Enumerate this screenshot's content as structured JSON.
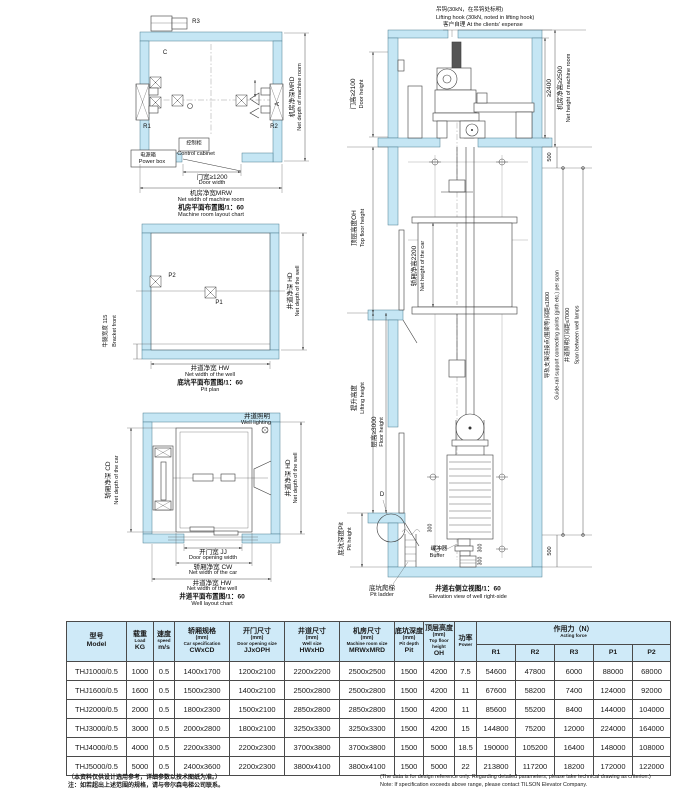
{
  "colors": {
    "wall": "#c5e6f4",
    "table_header": "#cfeaf8",
    "line": "#3c3c3c"
  },
  "machine_room": {
    "r1": "R1",
    "r2": "R2",
    "r3": "R3",
    "c": "C",
    "a": "A",
    "control_cabinet_cn": "控制柜",
    "control_cabinet_en": "Control cabinet",
    "power_box_cn": "电源箱",
    "power_box_en": "Power box",
    "door_width_cn": "门宽≥1200",
    "door_width_en": "Door width",
    "width_cn": "机房净宽MRW",
    "width_en": "Net width of machine room",
    "depth_cn": "机房净深MRD",
    "depth_en": "Net depth of machine room",
    "caption_cn": "机房平面布置图/1：60",
    "caption_en": "Machine room layout chart"
  },
  "pit_plan": {
    "p1": "P1",
    "p2": "P2",
    "bracket_cn": "牛腿宽度 115",
    "bracket_en": "Bracket front",
    "width_cn": "井道净宽 HW",
    "width_en": "Net width of the well",
    "depth_cn": "井道净深 HD",
    "depth_en": "Net depth of the well",
    "caption_cn": "底坑平面布置图/1：60",
    "caption_en": "Pit plan"
  },
  "well_plan": {
    "lighting_cn": "井道照明",
    "lighting_en": "Well lighting",
    "car_depth_cn": "轿厢净深 CD",
    "car_depth_en": "Net depth of the car",
    "well_depth_cn": "井道净深 HD",
    "well_depth_en": "Net depth of the well",
    "door_cn": "开门宽 JJ",
    "door_en": "Door opening width",
    "car_width_cn": "轿厢净宽 CW",
    "car_width_en": "Net width of the car",
    "well_width_cn": "井道净宽 HW",
    "well_width_en": "Net width of the well",
    "caption_cn": "井道平面布置图/1：60",
    "caption_en": "Well layout chart"
  },
  "elevation": {
    "hook_cn": "吊钩(30kN，在吊钩处标明)",
    "hook_en": "Lifting hook (30kN, noted in lifting hook)",
    "expense": "客户自理 At the clients'  expense",
    "door_height_cn": "门高≥2100",
    "door_height_en": "Door height",
    "dim_2400": "≥2400",
    "mr_height_cn": "机房净高≥2500",
    "mr_height_en": "Net height of machine room",
    "dim_500_top": "500",
    "dim_500_bottom": "500",
    "top_floor_cn": "顶层高度OH",
    "top_floor_en": "Top floor height",
    "car_height_cn": "轿厢净高2200",
    "car_height_en": "Net height of the car",
    "lifting_cn": "提升高度",
    "lifting_en": "Lifting height",
    "floor_cn": "层高≥3000",
    "floor_en": "Floor height",
    "pit_cn": "底坑深度Pit",
    "pit_en": "Pit height",
    "detail_d": "D",
    "dim_300_a": "300",
    "dim_300_b": "300",
    "dim_300_c": "300",
    "buffer_cn": "缓冲器",
    "buffer_en": "Buffer",
    "ladder_cn": "底坑爬梯",
    "ladder_en": "Pit ladder",
    "rail_cn": "导轨支架连接点(围梁等)间距≤1800",
    "rail_en": "Guide-rail support connecting points (girth etc.) per span",
    "lamp_cn": "井道照明灯间距≤7000",
    "lamp_en": "Span between well lamps",
    "caption_cn": "井道右侧立视图/1：60",
    "caption_en": "Elevation view of well right-side"
  },
  "table": {
    "columns": [
      {
        "cn": "型号",
        "code": "Model"
      },
      {
        "cn": "载重",
        "en": "Load",
        "code": "KG"
      },
      {
        "cn": "速度",
        "en": "speed",
        "code": "m/s"
      },
      {
        "cn": "轿厢规格",
        "mm": "(mm)",
        "en": "Car specification",
        "code": "CWxCD"
      },
      {
        "cn": "开门尺寸",
        "mm": "(mm)",
        "en": "Door opening size",
        "code": "JJxOPH"
      },
      {
        "cn": "井道尺寸",
        "mm": "(mm)",
        "en": "Well size",
        "code": "HWxHD"
      },
      {
        "cn": "机房尺寸",
        "mm": "(mm)",
        "en": "Machine room size",
        "code": "MRWxMRD"
      },
      {
        "cn": "底坑深度",
        "mm": "(mm)",
        "en": "Pit depth",
        "code": "Pit"
      },
      {
        "cn": "顶层高度",
        "mm": "(mm)",
        "en": "Top floor height",
        "code": "OH"
      },
      {
        "cn": "功率",
        "en": "Power"
      }
    ],
    "force_header_cn": "作用力（N）",
    "force_header_en": "Acting force",
    "force_cols": [
      "R1",
      "R2",
      "R3",
      "P1",
      "P2"
    ],
    "rows": [
      [
        "THJ1000/0.5",
        "1000",
        "0.5",
        "1400x1700",
        "1200x2100",
        "2200x2200",
        "2500x2500",
        "1500",
        "4200",
        "7.5",
        "54600",
        "47800",
        "6000",
        "88000",
        "68000"
      ],
      [
        "THJ1600/0.5",
        "1600",
        "0.5",
        "1500x2300",
        "1400x2100",
        "2500x2800",
        "2500x2800",
        "1500",
        "4200",
        "11",
        "67600",
        "58200",
        "7400",
        "124000",
        "92000"
      ],
      [
        "THJ2000/0.5",
        "2000",
        "0.5",
        "1800x2300",
        "1500x2100",
        "2850x2800",
        "2850x2800",
        "1500",
        "4200",
        "11",
        "85600",
        "55200",
        "8400",
        "144000",
        "104000"
      ],
      [
        "THJ3000/0.5",
        "3000",
        "0.5",
        "2000x2800",
        "1800x2100",
        "3250x3300",
        "3250x3300",
        "1500",
        "4200",
        "15",
        "144800",
        "75200",
        "12000",
        "224000",
        "164000"
      ],
      [
        "THJ4000/0.5",
        "4000",
        "0.5",
        "2200x3300",
        "2200x2300",
        "3700x3800",
        "3700x3800",
        "1500",
        "5000",
        "18.5",
        "190000",
        "105200",
        "16400",
        "148000",
        "108000"
      ],
      [
        "THJ5000/0.5",
        "5000",
        "0.5",
        "2400x3600",
        "2200x2300",
        "3800x4100",
        "3800x4100",
        "1500",
        "5000",
        "22",
        "213800",
        "117200",
        "18200",
        "172000",
        "122000"
      ]
    ]
  },
  "notes": {
    "cn1": "（本资料仅供设计选用参考，详细参数以技术图纸为准。）",
    "cn2": "注：如若超出上述范围的规格，请与帝尔森电梯公司联系。",
    "en1": "(The data is for design reference only.  Regarding detailed parameters, please take technical drawing as criterion.)",
    "en2": "Note:  If specification exceeds above range, please contact TILSON Elevator Company."
  }
}
